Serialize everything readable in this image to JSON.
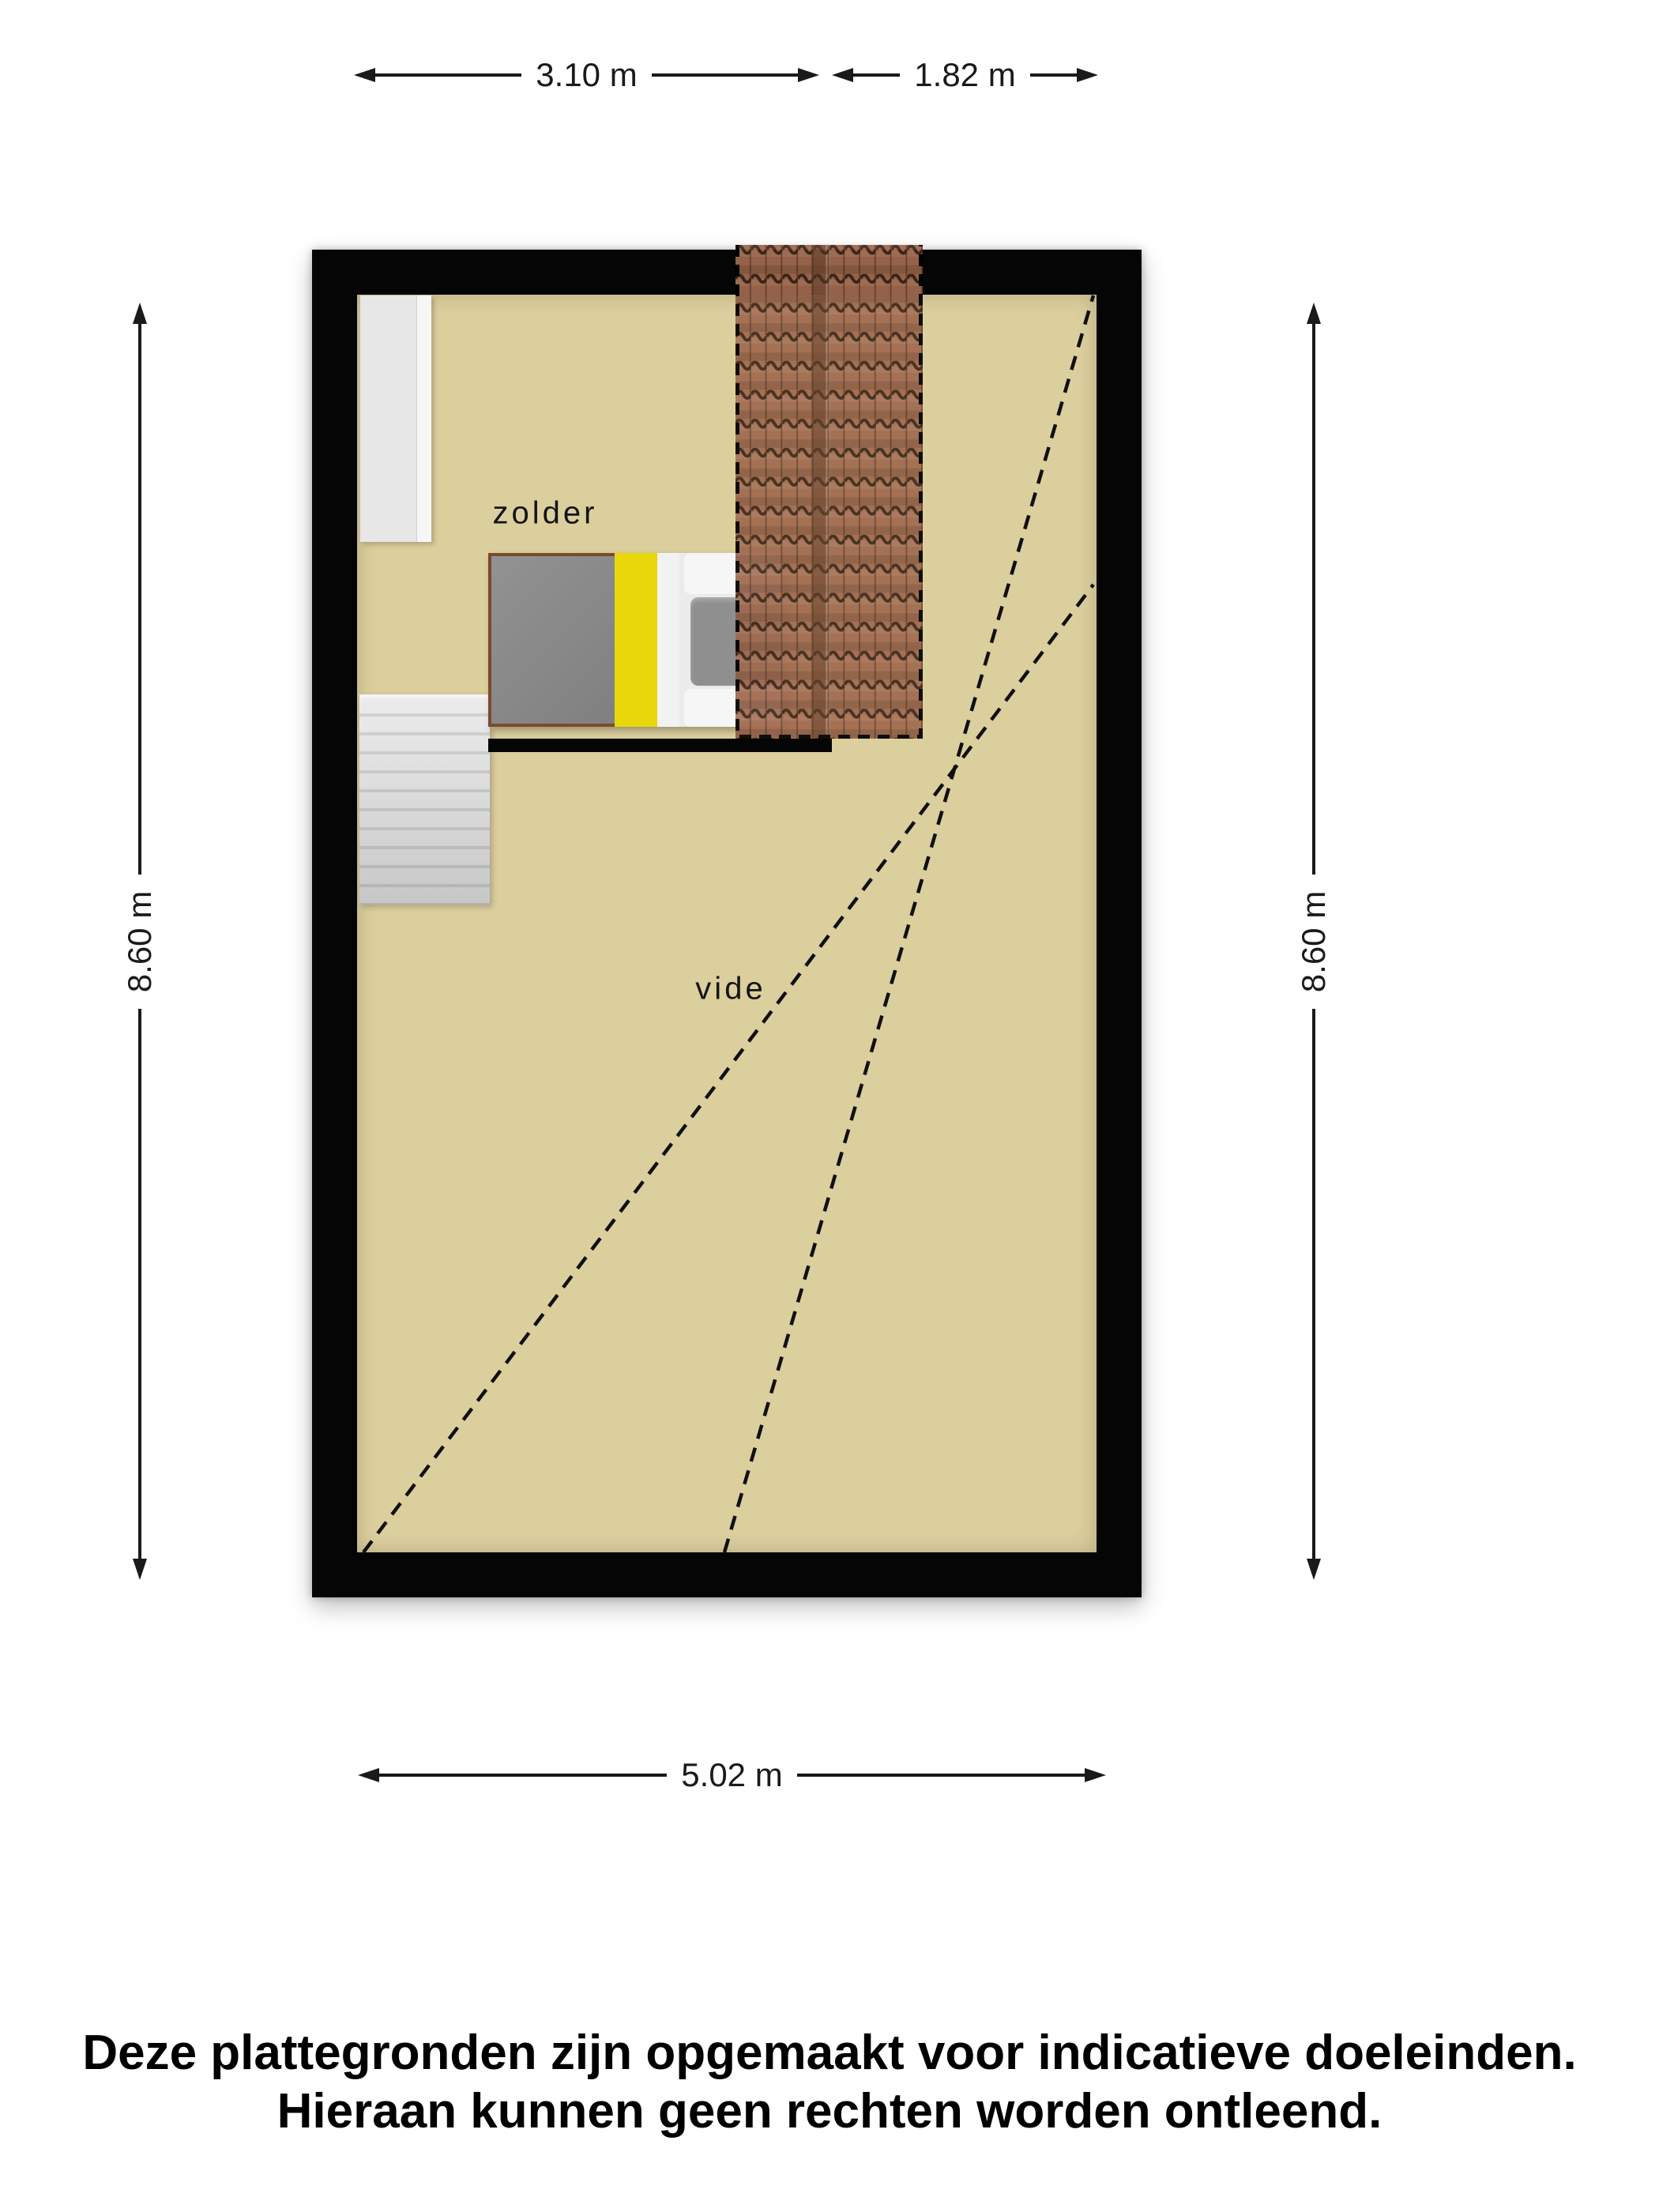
{
  "rooms": {
    "attic_label": "zolder",
    "void_label": "vide"
  },
  "dimensions": {
    "top_width_left": "3.10 m",
    "top_width_right": "1.82 m",
    "side_height_left": "8.60 m",
    "side_height_right": "8.60 m",
    "bottom_width": "5.02 m"
  },
  "disclaimer": {
    "line1": "Deze plattegronden zijn opgemaakt voor indicatieve doeleinden.",
    "line2": "Hieraan kunnen geen rechten worden ontleend."
  },
  "colors": {
    "floor": "#dccf9e",
    "wall": "#050505",
    "tile-base": "#a06a4f",
    "tile-line": "#3f2719",
    "tile-seam": "#5e3a27",
    "bed-blanket": "#8b8b8b",
    "bed-accent": "#e8d70a",
    "bed-linen": "#f2f2f2",
    "stairs": "#d9d9d9",
    "closet": "#e7e7e7",
    "dimension": "#1a1a1a"
  }
}
